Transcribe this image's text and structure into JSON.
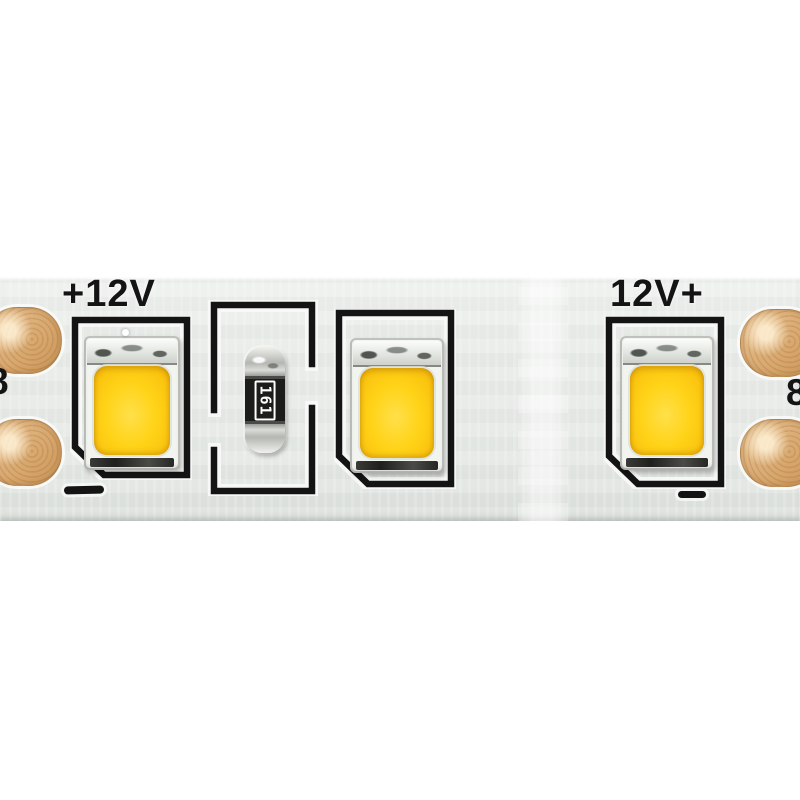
{
  "strip": {
    "polarity_label_left": "+12V",
    "polarity_label_right": "12V+",
    "resistor_code": "161",
    "edge_glyph_left": "8",
    "edge_glyph_right": "8",
    "colors": {
      "canvas_bg": "#ffffff",
      "pcb": "#e9ece9",
      "copper": "#ddb07a",
      "print": "#141414",
      "led_body": "#f2f4f0",
      "led_yellow": "#ffd318",
      "led_yellow_deep": "#edb30c",
      "resistor_cap": "#b4b6b1",
      "resistor_body": "#1c1c1a"
    }
  }
}
